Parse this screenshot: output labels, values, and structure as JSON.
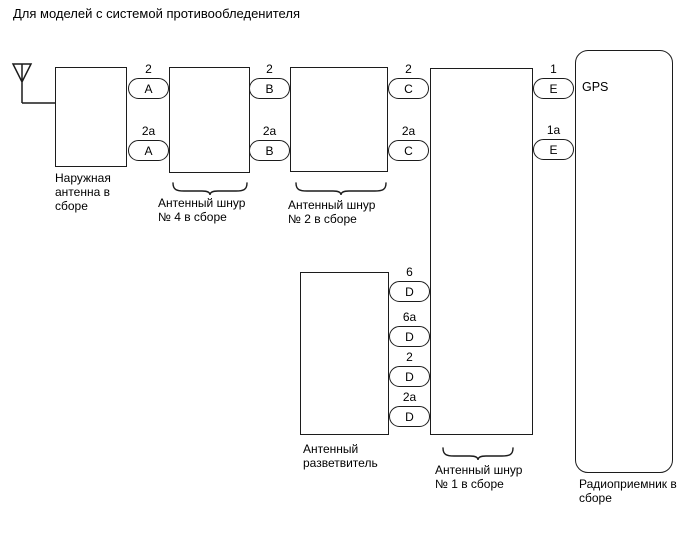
{
  "title": "Для моделей с системой противообледенителя",
  "colors": {
    "line": "#1c1c1c",
    "background": "#ffffff",
    "text": "#000000"
  },
  "icons": {
    "antenna": "antenna-icon",
    "brace": "curly-brace"
  },
  "boxes": {
    "outdoor_antenna": {
      "label_lines": [
        "Наружная",
        "антенна в",
        "сборе"
      ]
    },
    "cord4": {
      "label_lines": [
        "Антенный шнур",
        "№ 4 в сборе"
      ]
    },
    "cord2": {
      "label_lines": [
        "Антенный шнур",
        "№ 2 в сборе"
      ]
    },
    "splitter": {
      "label_lines": [
        "Антенный",
        "разветвитель"
      ]
    },
    "cord1": {
      "label_lines": [
        "Антенный шнур",
        "№ 1 в сборе"
      ]
    },
    "radio": {
      "label_lines": [
        "Радиоприемник в",
        "сборе"
      ],
      "gps_label": "GPS"
    }
  },
  "connectors": [
    {
      "pin": "2",
      "letter": "A"
    },
    {
      "pin": "2a",
      "letter": "A"
    },
    {
      "pin": "2",
      "letter": "B"
    },
    {
      "pin": "2a",
      "letter": "B"
    },
    {
      "pin": "2",
      "letter": "C"
    },
    {
      "pin": "2a",
      "letter": "C"
    },
    {
      "pin": "6",
      "letter": "D"
    },
    {
      "pin": "6a",
      "letter": "D"
    },
    {
      "pin": "2",
      "letter": "D"
    },
    {
      "pin": "2a",
      "letter": "D"
    },
    {
      "pin": "1",
      "letter": "E"
    },
    {
      "pin": "1a",
      "letter": "E"
    }
  ]
}
